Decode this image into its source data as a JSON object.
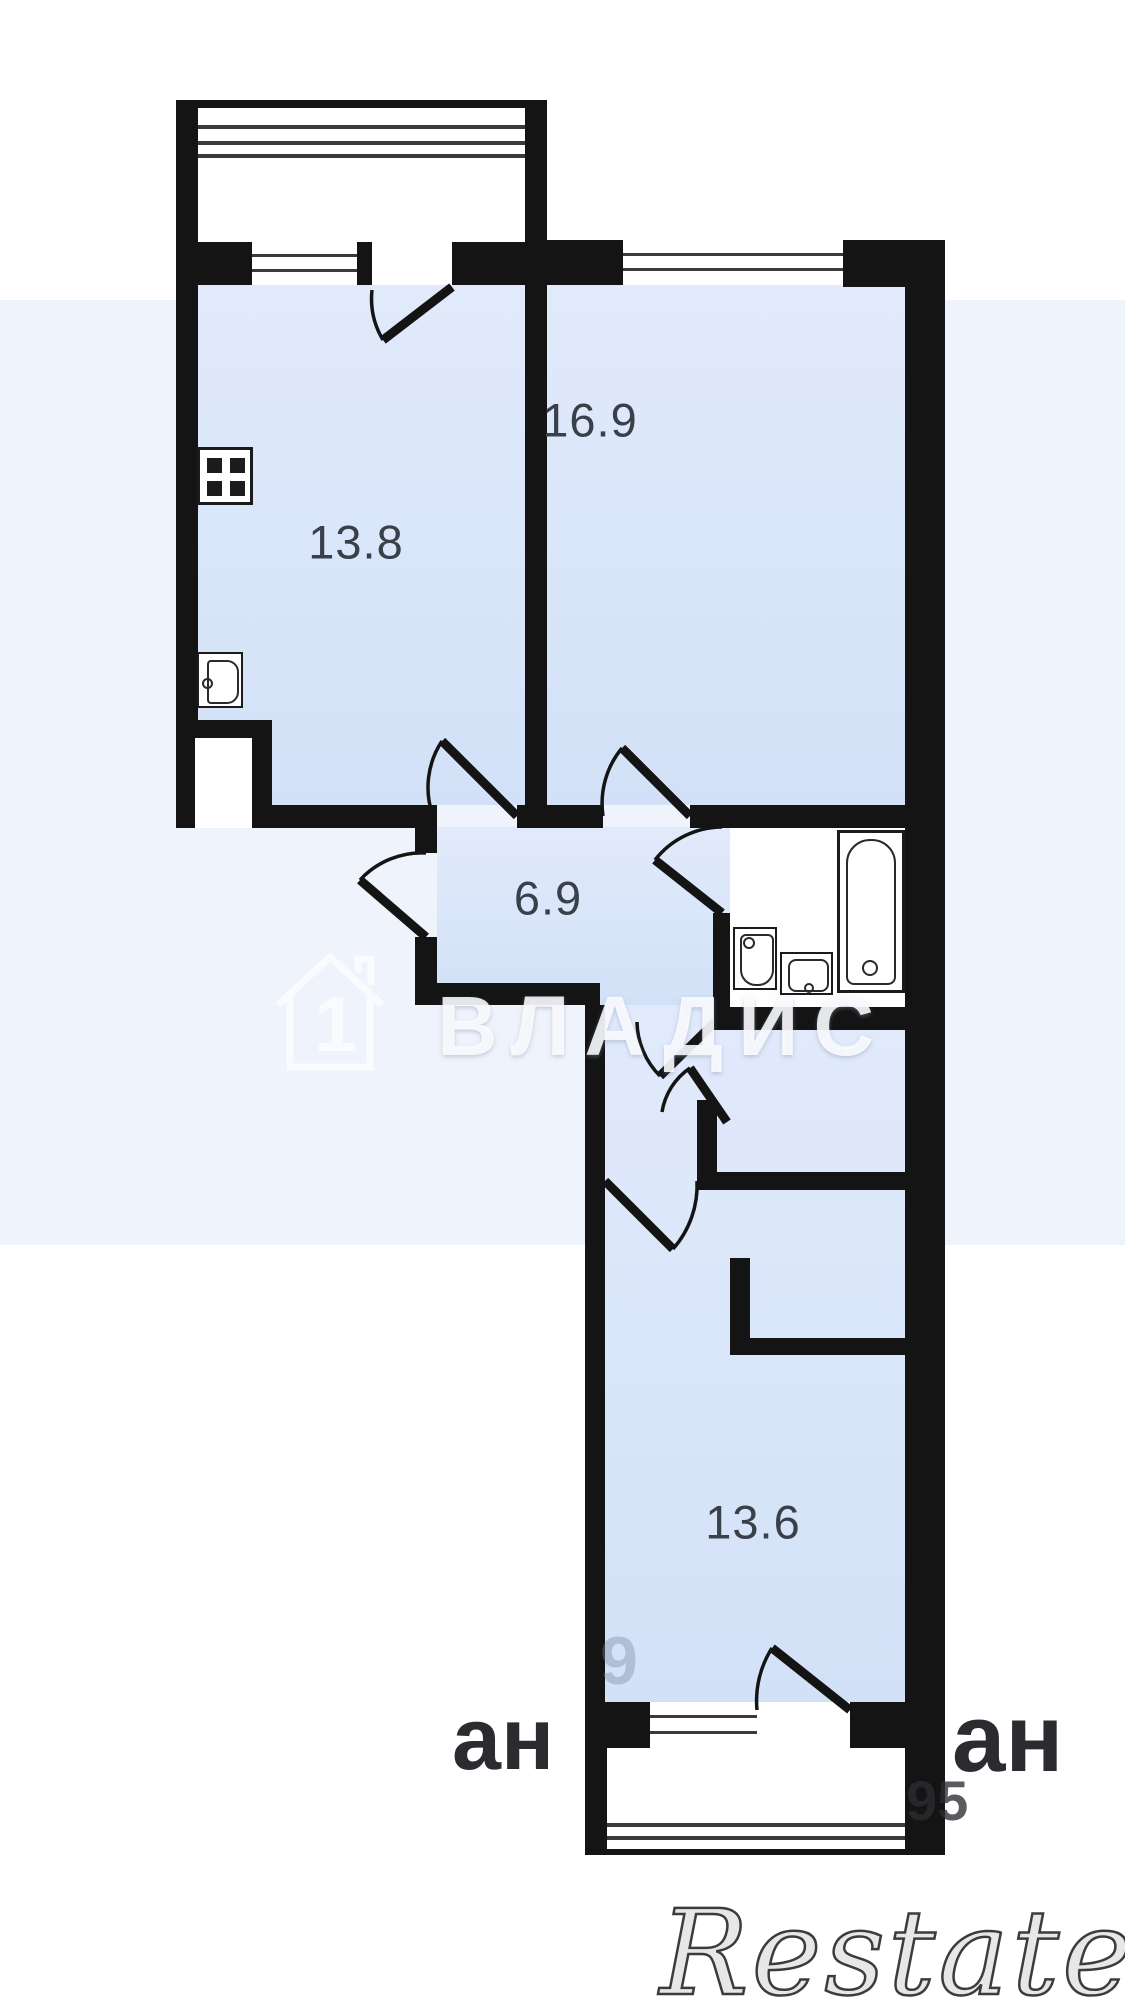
{
  "page": {
    "background": "#ffffff",
    "tint_band_color": "#dfe8f7",
    "wall_color": "#141414",
    "room_fill": "#d9e5f9",
    "label_color": "#39404a"
  },
  "plan": {
    "rooms": [
      {
        "id": "kitchen",
        "area": "13.8"
      },
      {
        "id": "living-room",
        "area": "16.9"
      },
      {
        "id": "hallway",
        "area": "6.9"
      },
      {
        "id": "bedroom",
        "area": "13.6"
      }
    ],
    "fixtures": [
      "stove-icon",
      "kitchen-sink-icon",
      "vent-shaft",
      "washbasin-icon",
      "washing-machine-icon",
      "bathtub-icon"
    ],
    "windows": [
      "balcony-glazing-top",
      "kitchen-window",
      "living-room-window",
      "bedroom-window",
      "balcony-glazing-bottom"
    ]
  },
  "watermarks": {
    "vladis": {
      "text": "ВЛАДИС",
      "house_number": "1"
    },
    "restate": {
      "text": "Restate"
    },
    "fragments": {
      "left": "ан",
      "right": "ан",
      "number": "95",
      "ghost_digit": "9"
    }
  }
}
